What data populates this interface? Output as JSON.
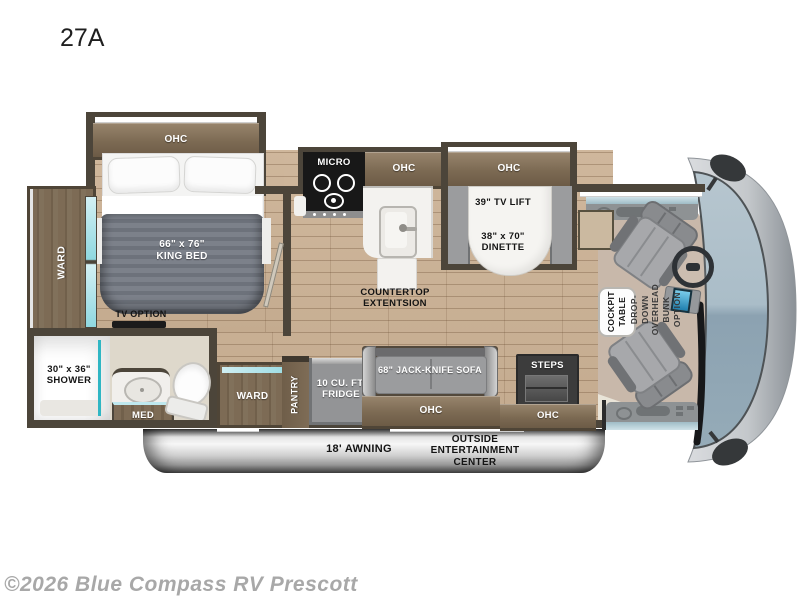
{
  "page": {
    "title": "27A",
    "copyright": "©2026 Blue Compass RV Prescott"
  },
  "colors": {
    "accent_teal": "#2fb6c4",
    "wood_floor": "#c9b197",
    "cabinet_wood": "#7c6a53",
    "wall": "#4c453a",
    "furniture_gray": "#9b9c9e",
    "windshield_glass": "#a9bec9",
    "awning_gray": "#cfcfcf",
    "bath_floor": "#ded8cb",
    "cab_carpet": "#c8b8aa"
  },
  "labels": {
    "ohc": "OHC",
    "king_bed": "66\" x 76\"\nKING BED",
    "ward_rear": "WARD",
    "tv_option": "TV OPTION",
    "shower": "30\" x 36\"\nSHOWER",
    "med": "MED",
    "micro": "MICRO",
    "countertop_extension": "COUNTERTOP\nEXTENTSION",
    "tv_lift": "39\" TV LIFT",
    "dinette": "38\" x 70\"\nDINETTE",
    "ward_bath": "WARD",
    "pantry": "PANTRY",
    "fridge": "10 CU. FT.\nFRIDGE",
    "sofa": "68\" JACK-KNIFE SOFA",
    "steps": "STEPS",
    "awning": "18' AWNING",
    "outside_entertainment": "OUTSIDE\nENTERTAINMENT\nCENTER",
    "cockpit_table": "COCKPIT\nTABLE",
    "overhead_bunk": "DROP-DOWN\nOVERHEAD BUNK\nOPTION"
  }
}
